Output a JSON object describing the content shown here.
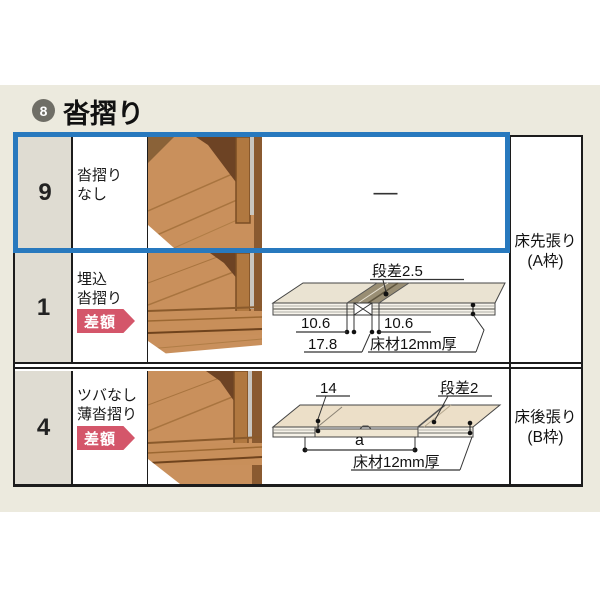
{
  "header": {
    "badge_number": "8",
    "title": "沓摺り"
  },
  "rows": [
    {
      "num": "9",
      "label_line1": "沓摺り",
      "label_line2": "なし",
      "badge": "",
      "dash": "—"
    },
    {
      "num": "1",
      "label_line1": "埋込",
      "label_line2": "沓摺り",
      "badge": "差額"
    },
    {
      "num": "4",
      "label_line1": "ツバなし",
      "label_line2": "薄沓摺り",
      "badge": "差額"
    }
  ],
  "right_labels": {
    "a_line1": "床先張り",
    "a_line2": "(A枠)",
    "b_line1": "床後張り",
    "b_line2": "(B枠)"
  },
  "diagram_row1": {
    "step": "段差2.5",
    "dim_left": "10.6",
    "dim_right": "10.6",
    "dim_total": "17.8",
    "material": "床材12mm厚"
  },
  "diagram_row4": {
    "dim_top": "14",
    "step": "段差2",
    "dim_a": "a",
    "material": "床材12mm厚"
  },
  "colors": {
    "highlight_blue": "#2879be",
    "badge_red": "#d4566a",
    "band_bg": "#eceade",
    "number_cell": "#dfdcd2",
    "border_black": "#1c1c1c",
    "wood_light": "#c9905c",
    "wood_dark": "#6d4324",
    "diagram_cream": "#eae3d2"
  }
}
